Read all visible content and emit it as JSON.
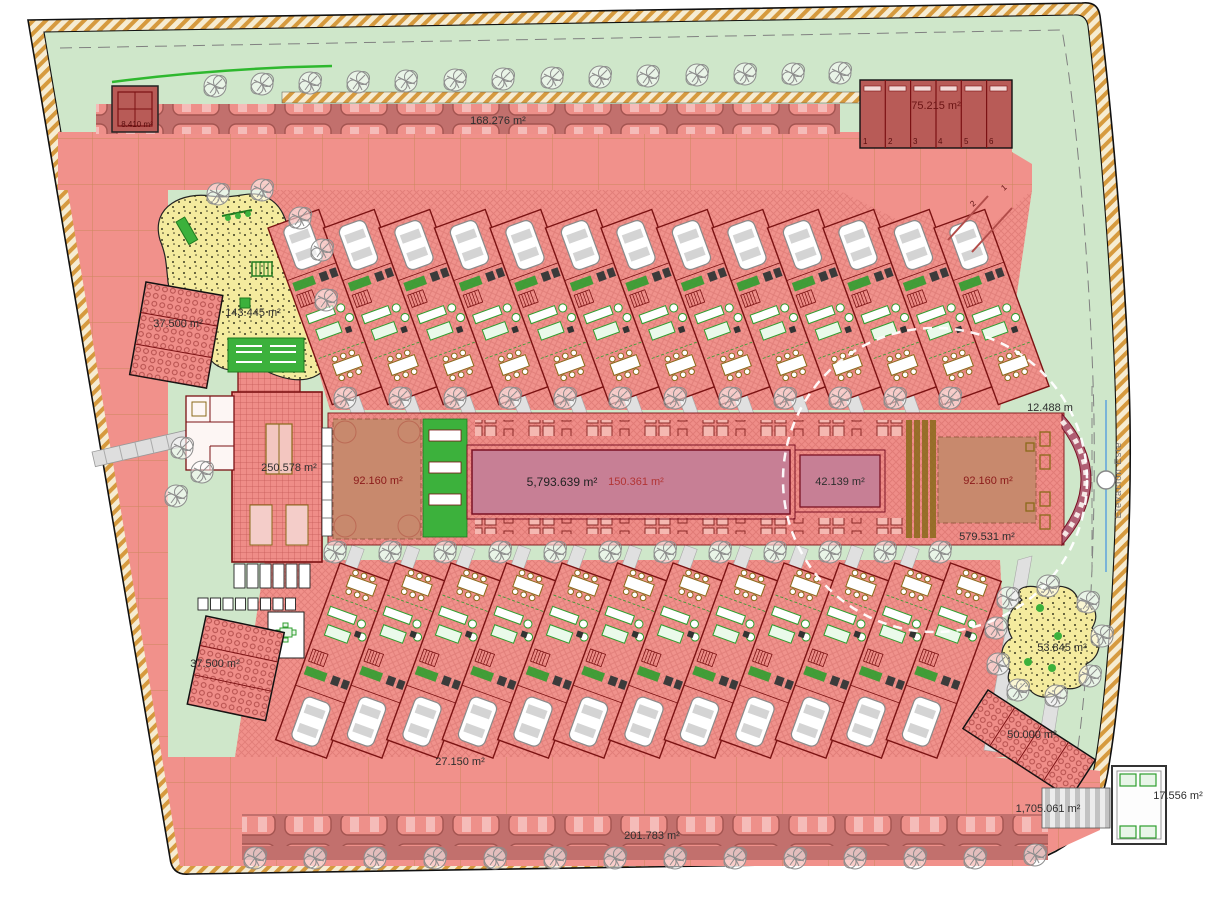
{
  "plan": {
    "areas": {
      "gate_booth": "8.410 m²",
      "garage_block": "75.215 m²",
      "top_parking": "168.276 m²",
      "playground_west": "143.445 m²",
      "storage_northwest": "37.500 m²",
      "clubhouse": "250.578 m²",
      "deck_west": "92.160 m²",
      "main_pool": "5,793.639 m²",
      "pool_walkway": "150.361 m²",
      "kids_pool": "42.139 m²",
      "deck_east": "92.160 m²",
      "east_width": "12.488 m",
      "deck_south": "579.531 m²",
      "playground_east": "53.845 m²",
      "carport_southeast": "50.000 m²",
      "gatehouse_east": "17.556 m²",
      "ring_road": "1,705.061 m²",
      "bottom_parking": "201.783 m²",
      "house_row_south": "27.150 m²",
      "storage_southwest": "37.500 m²"
    },
    "garage_numbers": [
      "1",
      "2",
      "3",
      "4",
      "5",
      "6"
    ],
    "visitor_spots": [
      "2",
      "1"
    ],
    "elevation_label": "Elevacion Este"
  }
}
